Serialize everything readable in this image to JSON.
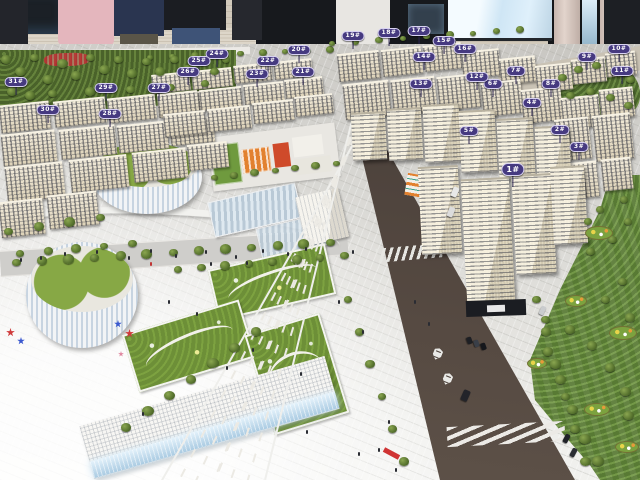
{
  "scene": {
    "subject": "architectural-scale-model-showroom-photo"
  },
  "signs": {
    "labels": [
      "1#",
      "2#",
      "3#",
      "4#",
      "5#",
      "6#",
      "7#",
      "8#",
      "9#",
      "10#",
      "11#",
      "12#",
      "13#",
      "14#",
      "15#",
      "16#",
      "17#",
      "18#",
      "19#",
      "20#",
      "21#",
      "22#",
      "23#",
      "24#",
      "25#",
      "26#",
      "27#",
      "28#",
      "29#",
      "30#",
      "31#"
    ]
  },
  "colors": {
    "sign_bg": "#463a80",
    "sign_border": "#d8d2f2",
    "sign_text": "#ffffff",
    "park_green": "#5d7a33",
    "lawn_green": "#7aa03d",
    "road_asphalt": "#544840",
    "plaza": "#e2e1dd",
    "building_cream": "#ece3cc",
    "glass_glow": "#cfe6f5",
    "school_orange": "#e2812f",
    "wall_beige": "#cfc6b8"
  }
}
